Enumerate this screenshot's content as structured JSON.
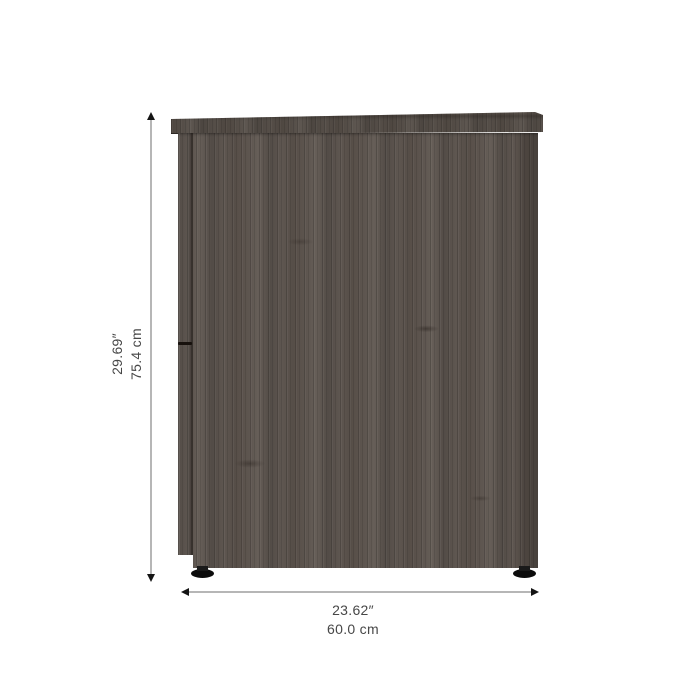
{
  "figure": {
    "description": "Front view of a dark gray wood-grain cabinet with two round black feet, annotated with height and width dimension lines"
  },
  "dimensions": {
    "height": {
      "inches": "29.69″",
      "cm": "75.4 cm"
    },
    "width": {
      "inches": "23.62″",
      "cm": "60.0 cm"
    }
  },
  "colors": {
    "background": "#ffffff",
    "wood_base": "#5e5650",
    "wood_top_panel": "#554e48",
    "foot": "#0c0c0c",
    "dimension_line": "#b6b6b6",
    "arrowhead": "#141414",
    "label_text": "#474747"
  }
}
